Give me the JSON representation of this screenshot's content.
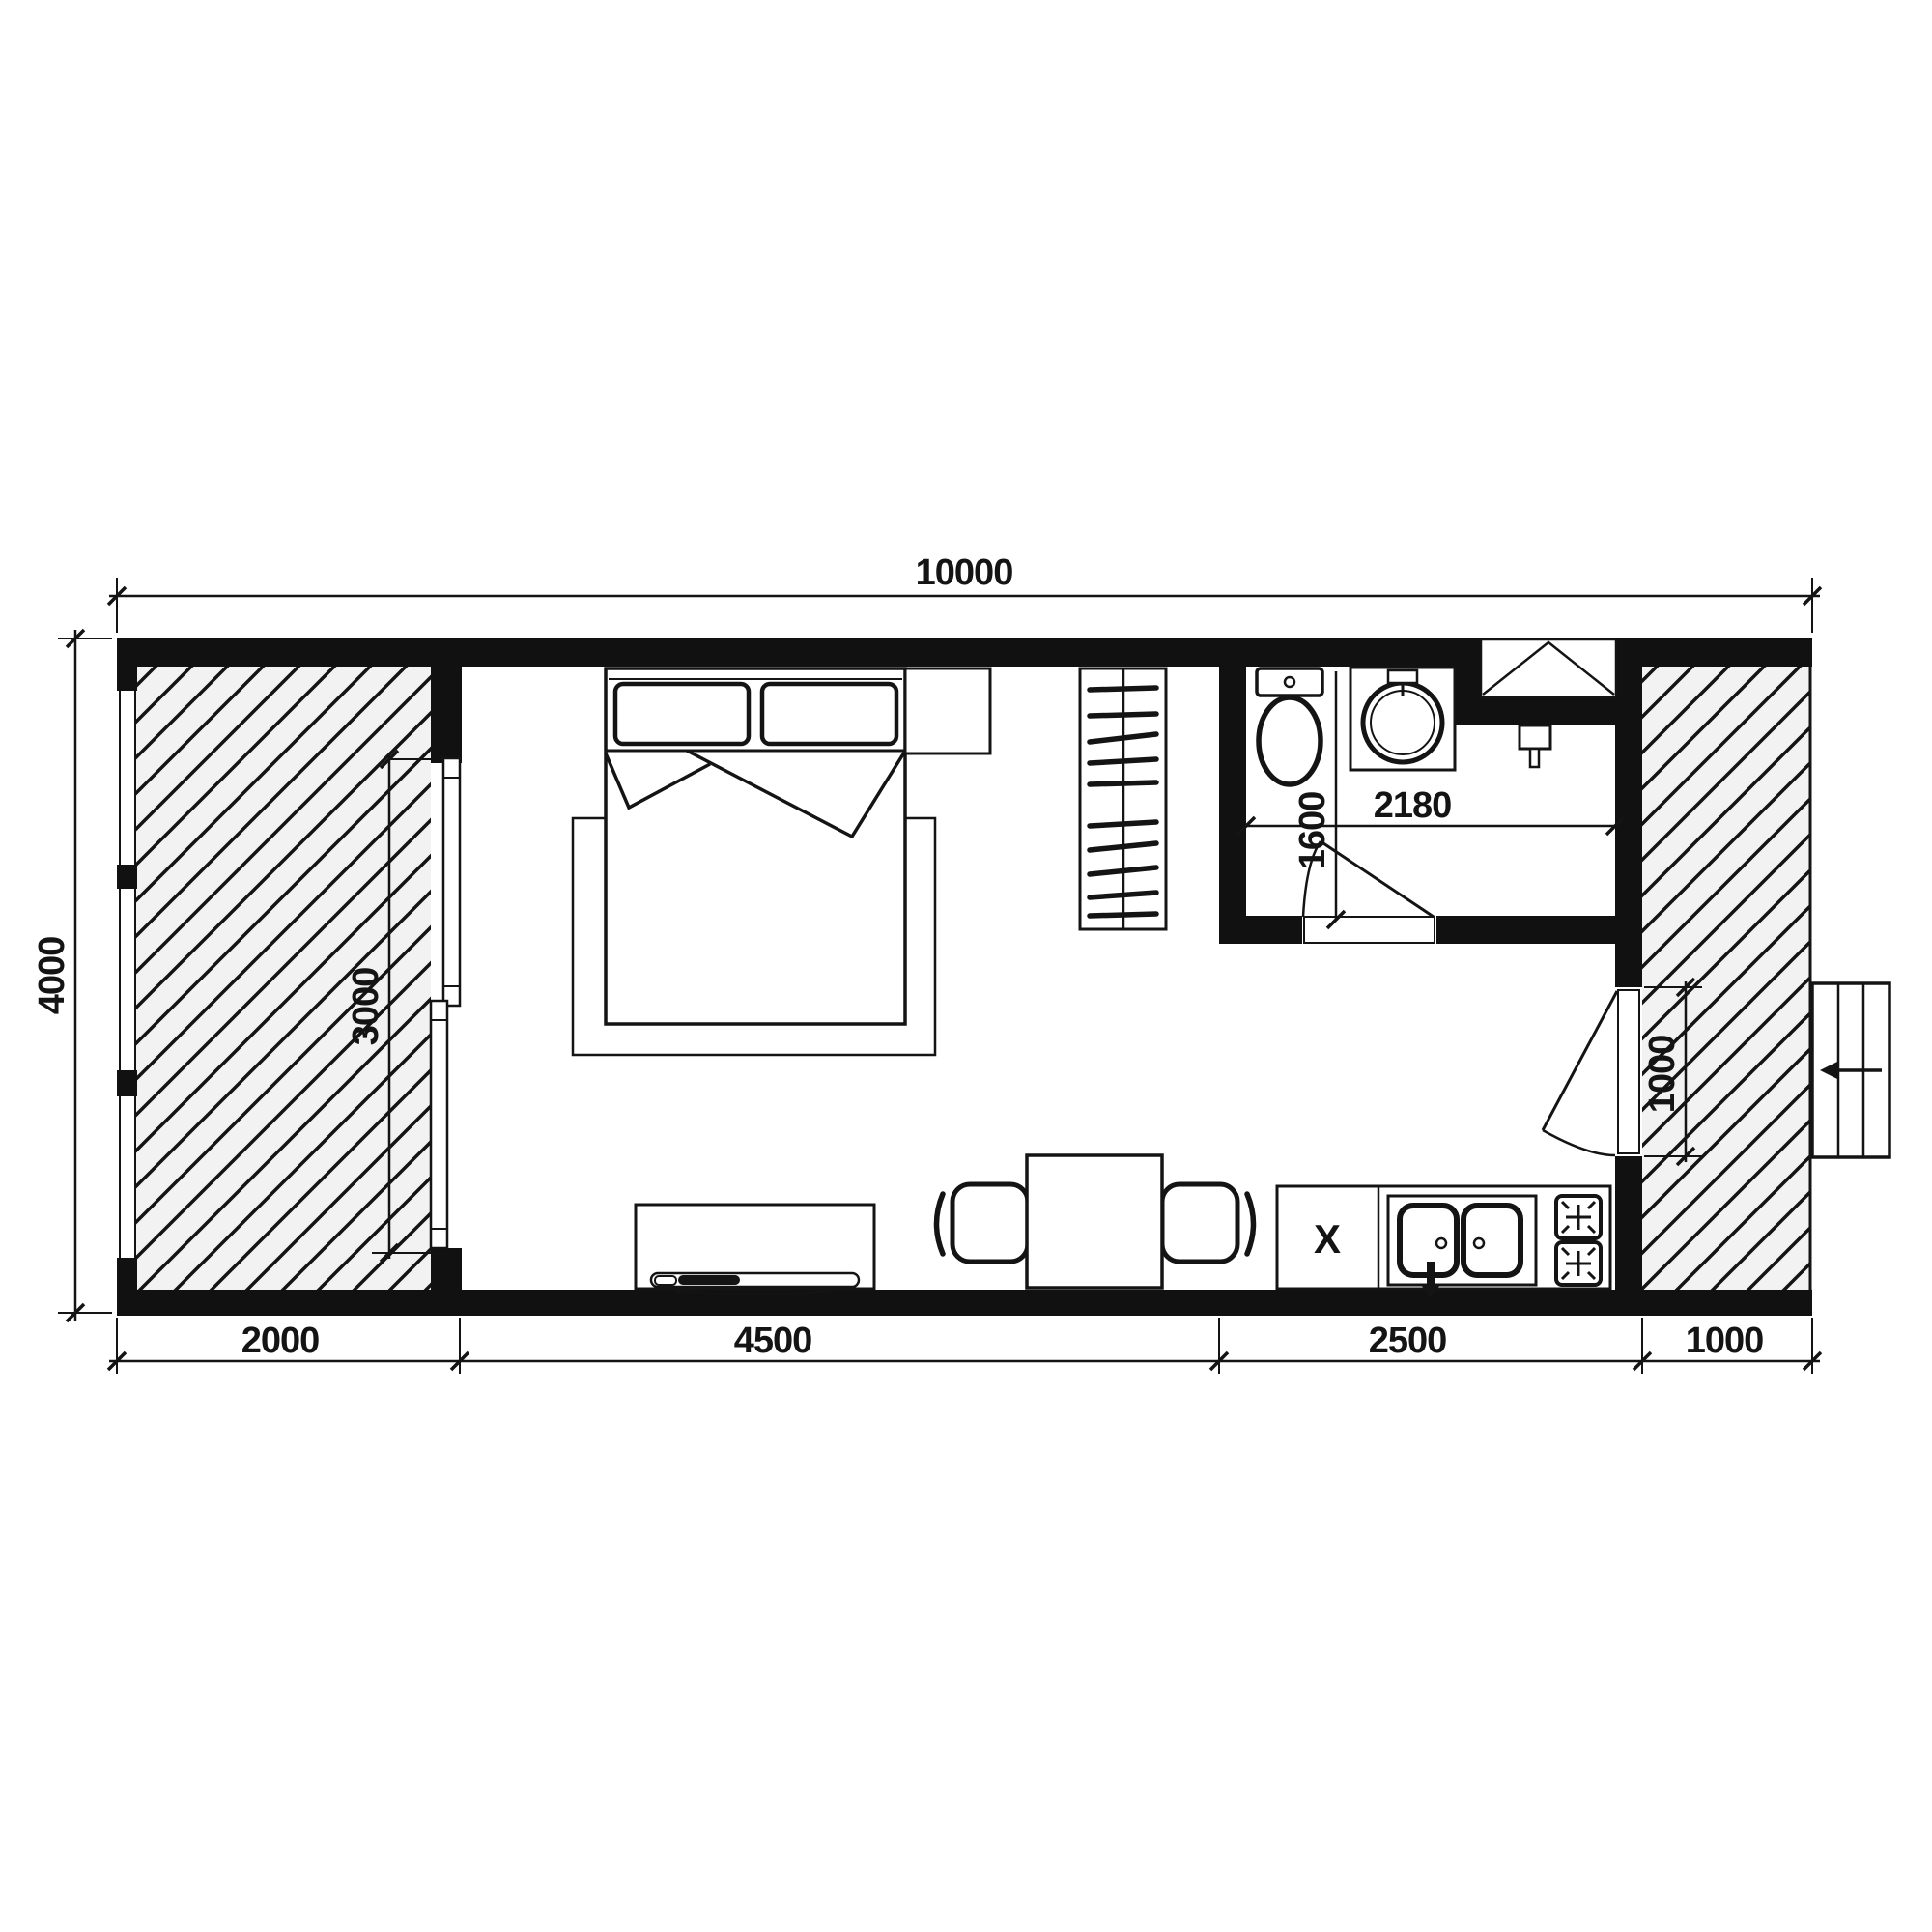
{
  "dimensions": {
    "overall_width": "10000",
    "overall_height": "4000",
    "bottom_segments": [
      "2000",
      "4500",
      "2500",
      "1000"
    ],
    "terrace_door_opening": "3000",
    "entry_door_width": "1000",
    "bathroom_depth": "1600",
    "bathroom_width": "2180"
  },
  "labels": {
    "appliance_marker": "X"
  },
  "colors": {
    "line": "#141414",
    "wall_fill": "#111111",
    "terrace_background": "#f2f2f2"
  }
}
